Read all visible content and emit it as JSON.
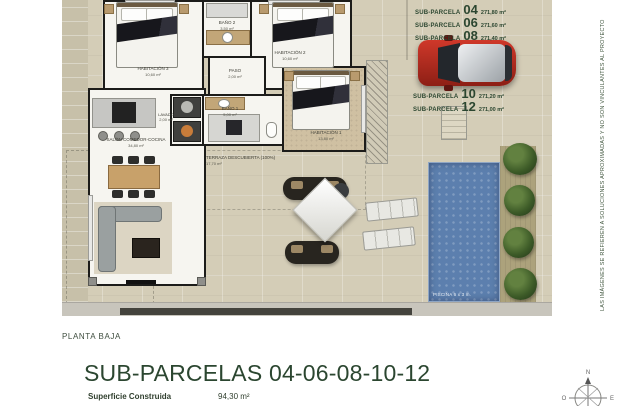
{
  "colors": {
    "site_beige": "#d4cdb7",
    "wall_black": "#1c1c1a",
    "text_green": "#2b4630",
    "pool_blue": "#5c7fae",
    "car_red": "#b2291d",
    "bush_green": "#3c5a27"
  },
  "side_note": "LAS IMÁGENES SE REFIEREN A SOLUCIONES APROXIMADAS Y NO SON VINCULANTES AL PROYECTO",
  "parcels": [
    {
      "label": "SUB-PARCELA",
      "num": "04",
      "area": "271,80 m²"
    },
    {
      "label": "SUB-PARCELA",
      "num": "06",
      "area": "271,60 m²"
    },
    {
      "label": "SUB-PARCELA",
      "num": "08",
      "area": "271,40 m²"
    },
    {
      "label": "SUB-PARCELA",
      "num": "10",
      "area": "271,20 m²"
    },
    {
      "label": "SUB-PARCELA",
      "num": "12",
      "area": "271,00 m²"
    }
  ],
  "rooms": {
    "habitacion3": {
      "name": "HABITACIÓN 3",
      "area": "10,60 m²"
    },
    "bano2": {
      "name": "BAÑO 2",
      "area": "3,50 m²"
    },
    "habitacion2": {
      "name": "HABITACIÓN 2",
      "area": "10,60 m²"
    },
    "paso": {
      "name": "PASO",
      "area": "2,00 m²"
    },
    "lavado": {
      "name": "LAVADO",
      "area": "2,00 m²"
    },
    "bano1": {
      "name": "BAÑO 1",
      "area": "5,00 m²"
    },
    "habitacion1": {
      "name": "HABITACIÓN 1",
      "area": "13,80 m²"
    },
    "salon": {
      "name": "SALÓN COMEDOR-COCINA",
      "area": "34,80 m²"
    },
    "terraza": {
      "name": "TERRAZA DESCUBIERTA (100%)",
      "area": "17,70 m²"
    }
  },
  "pool_label": "PISCINA 6 x 3 m.",
  "footer": {
    "floor_label": "PLANTA BAJA",
    "title": "SUB-PARCELAS 04-06-08-10-12",
    "surface_label": "Superficie Construida",
    "surface_value": "94,30 m²"
  },
  "compass": {
    "north": "N",
    "west": "O",
    "east": "E"
  }
}
